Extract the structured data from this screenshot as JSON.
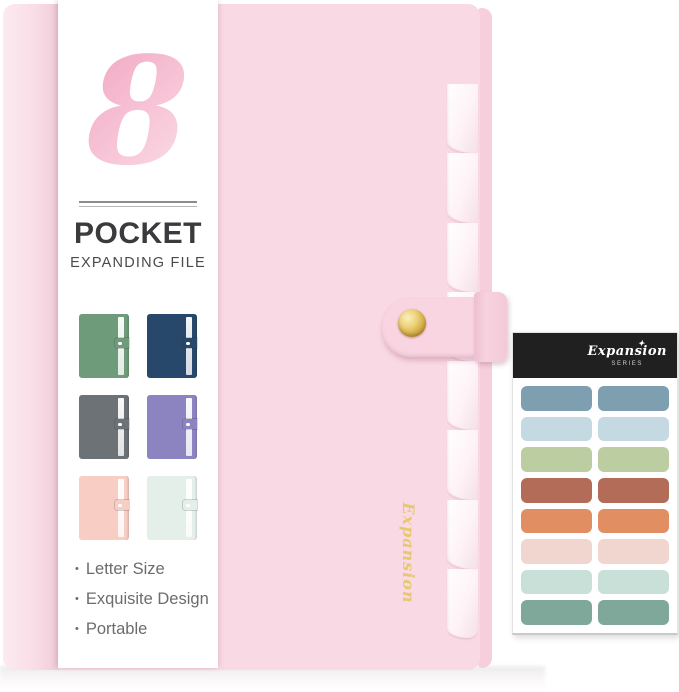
{
  "product": {
    "info_panel": {
      "pocket_count": "8",
      "title": "POCKET",
      "subtitle": "EXPANDING FILE",
      "bullet": "•",
      "features": [
        "Letter Size",
        "Exquisite Design",
        "Portable"
      ],
      "color_variants": [
        {
          "name": "green",
          "color": "#6E9B79"
        },
        {
          "name": "navy",
          "color": "#27486B"
        },
        {
          "name": "gray",
          "color": "#6D7277"
        },
        {
          "name": "purple",
          "color": "#8B84C0"
        },
        {
          "name": "blush",
          "color": "#F7CDC4"
        },
        {
          "name": "mint",
          "color": "#E5EFE9"
        }
      ]
    },
    "folder": {
      "cover_color": "#F9DAE4",
      "spine_edge_color": "#F6CEDC",
      "strap_color": "#F8D5E1",
      "script_text": "Expansion",
      "script_color": "#E7C76B"
    },
    "sticker_sheet": {
      "header_color": "#202020",
      "script_text": "Expansion",
      "sparkle": "✦",
      "series_label": "SERIES",
      "label_colors": [
        "#7E9FB0",
        "#C5D9E3",
        "#BDCDA2",
        "#B26C57",
        "#E18E63",
        "#F0D6CE",
        "#C8E0D7",
        "#80A89A"
      ]
    }
  }
}
